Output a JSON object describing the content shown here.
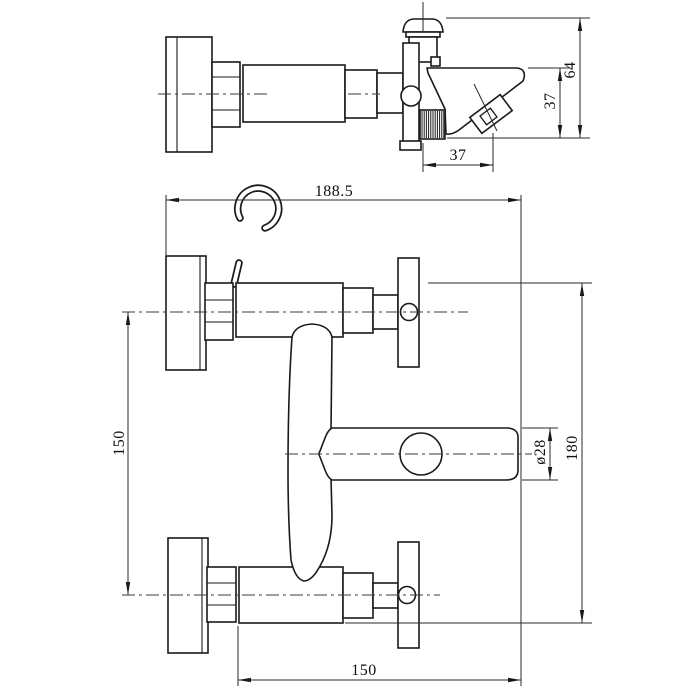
{
  "drawing": {
    "background": "#ffffff",
    "line_color": "#1a1a1a",
    "views": {
      "top": {
        "name": "side-profile-view"
      },
      "front": {
        "name": "front-elevation-view"
      }
    },
    "dimensions": {
      "top_view": {
        "overall_height": "64",
        "spout_to_outlet_height": "37",
        "outlet_horizontal_offset": "37"
      },
      "front_view": {
        "overall_length": "188.5",
        "inlet_center_spacing": "150",
        "spout_end_diameter": "ø28",
        "overall_height": "180",
        "spout_reach": "150"
      }
    }
  }
}
